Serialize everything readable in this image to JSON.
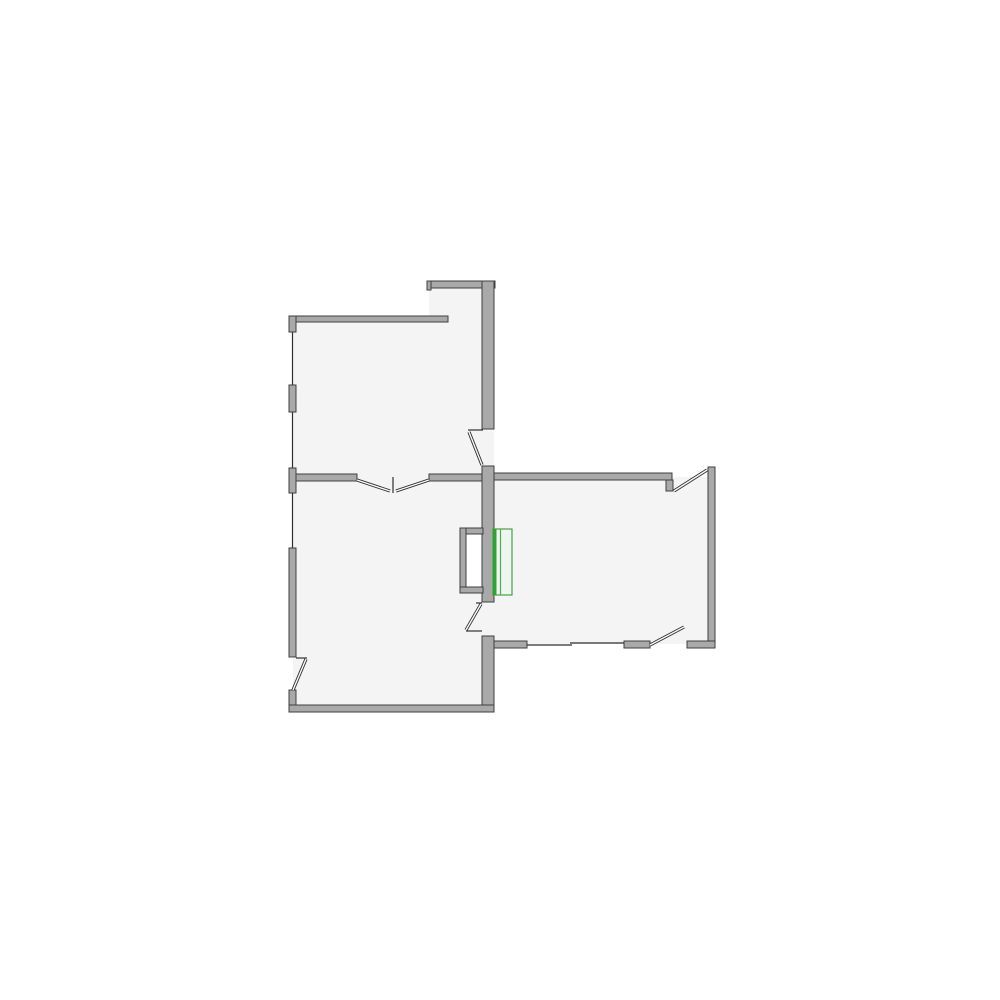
{
  "palette": {
    "background": "#ffffff",
    "room_fill": "#f4f4f5",
    "wall_fill": "#a9a9a9",
    "wall_stroke": "#3f3f3f",
    "window_line": "#2f2f2f",
    "door_line": "#2f2f2f",
    "leaf_core": "#fafafa",
    "void_fill": "#ffffff",
    "radiator_outline": "#46a046",
    "radiator_accent": "#2fa32f",
    "radiator_divider": "#55a855",
    "radiator_fill": "#eff5ef"
  },
  "floorplan": {
    "canvas": {
      "width": 1000,
      "height": 1000
    },
    "rooms": [
      {
        "name": "room-top-left-alcove",
        "x": 429,
        "y": 286,
        "w": 57,
        "h": 36
      },
      {
        "name": "room-top-left",
        "x": 293,
        "y": 320,
        "w": 193,
        "h": 161
      },
      {
        "name": "room-bottom-left",
        "x": 293,
        "y": 474,
        "w": 193,
        "h": 234
      },
      {
        "name": "room-right",
        "x": 486,
        "y": 477,
        "w": 226,
        "h": 167
      }
    ],
    "doorway_fills": [
      {
        "name": "doorway-upper-spine",
        "x": 482,
        "y": 429,
        "w": 12,
        "h": 37
      },
      {
        "name": "doorway-lower-spine",
        "x": 482,
        "y": 602,
        "w": 12,
        "h": 34
      }
    ],
    "void_interior": {
      "name": "wall-niche-interior",
      "x": 466,
      "y": 534,
      "w": 17,
      "h": 53
    },
    "walls": [
      {
        "name": "wall-alcove-top",
        "x": 429,
        "y": 281,
        "w": 66,
        "h": 7
      },
      {
        "name": "wall-alcove-end-cap",
        "x": 427,
        "y": 281,
        "w": 4,
        "h": 9
      },
      {
        "name": "wall-topleft-top",
        "x": 289,
        "y": 316,
        "w": 159,
        "h": 6
      },
      {
        "name": "wall-left-block-1",
        "x": 289,
        "y": 316,
        "w": 7,
        "h": 16
      },
      {
        "name": "wall-left-block-2",
        "x": 289,
        "y": 385,
        "w": 7,
        "h": 27
      },
      {
        "name": "wall-left-block-3",
        "x": 289,
        "y": 468,
        "w": 7,
        "h": 25
      },
      {
        "name": "wall-left-block-4",
        "x": 289,
        "y": 548,
        "w": 7,
        "h": 109
      },
      {
        "name": "wall-left-block-5",
        "x": 289,
        "y": 690,
        "w": 7,
        "h": 22
      },
      {
        "name": "wall-interior-left",
        "x": 296,
        "y": 474,
        "w": 61,
        "h": 7
      },
      {
        "name": "wall-interior-right",
        "x": 429,
        "y": 474,
        "w": 54,
        "h": 7
      },
      {
        "name": "wall-spine-top",
        "x": 482,
        "y": 281,
        "w": 12,
        "h": 148
      },
      {
        "name": "wall-spine-mid",
        "x": 482,
        "y": 466,
        "w": 12,
        "h": 136
      },
      {
        "name": "wall-spine-bottom",
        "x": 482,
        "y": 636,
        "w": 12,
        "h": 76
      },
      {
        "name": "wall-bottomleft-bottom",
        "x": 289,
        "y": 705,
        "w": 205,
        "h": 7
      },
      {
        "name": "wall-right-room-top",
        "x": 494,
        "y": 473,
        "w": 178,
        "h": 7
      },
      {
        "name": "wall-right-top-door-notch",
        "x": 666,
        "y": 480,
        "w": 7,
        "h": 11
      },
      {
        "name": "wall-right-room-right",
        "x": 708,
        "y": 467,
        "w": 7,
        "h": 181
      },
      {
        "name": "wall-right-room-bottom-corner",
        "x": 687,
        "y": 641,
        "w": 28,
        "h": 7
      },
      {
        "name": "wall-right-room-bottom-mid",
        "x": 624,
        "y": 641,
        "w": 26,
        "h": 7
      },
      {
        "name": "wall-right-room-bottom-left",
        "x": 494,
        "y": 641,
        "w": 33,
        "h": 7
      },
      {
        "name": "wall-niche-top",
        "x": 460,
        "y": 528,
        "w": 23,
        "h": 6
      },
      {
        "name": "wall-niche-left",
        "x": 460,
        "y": 528,
        "w": 6,
        "h": 65
      },
      {
        "name": "wall-niche-bottom",
        "x": 460,
        "y": 587,
        "w": 23,
        "h": 6
      }
    ],
    "windows": [
      {
        "name": "window-left-1",
        "x1": 292.5,
        "y1": 332,
        "x2": 292.5,
        "y2": 385
      },
      {
        "name": "window-left-2",
        "x1": 292.5,
        "y1": 412,
        "x2": 292.5,
        "y2": 468
      },
      {
        "name": "window-left-3",
        "x1": 292.5,
        "y1": 493,
        "x2": 292.5,
        "y2": 548
      },
      {
        "name": "window-right-bottom-a",
        "x1": 527,
        "y1": 645,
        "x2": 572,
        "y2": 645
      },
      {
        "name": "window-right-bottom-b",
        "x1": 570,
        "y1": 643,
        "x2": 624,
        "y2": 643
      }
    ],
    "door_ticks": [
      {
        "name": "door-upper-spine-jamb",
        "x1": 468,
        "y1": 430,
        "x2": 483,
        "y2": 430
      },
      {
        "name": "door-double-center-post",
        "x1": 393,
        "y1": 477,
        "x2": 393,
        "y2": 493
      },
      {
        "name": "door-lower-spine-jamb-top",
        "x1": 476,
        "y1": 603,
        "x2": 482,
        "y2": 603
      },
      {
        "name": "door-lower-spine-jamb-bottom",
        "x1": 466,
        "y1": 631,
        "x2": 482,
        "y2": 631
      },
      {
        "name": "door-left-exit-jamb",
        "x1": 296,
        "y1": 658,
        "x2": 307,
        "y2": 658
      }
    ],
    "door_leaves": [
      {
        "name": "door-upper-spine-leaf",
        "x1": 469,
        "y1": 432,
        "x2": 482,
        "y2": 465
      },
      {
        "name": "door-double-leaf-left",
        "x1": 357,
        "y1": 480,
        "x2": 390,
        "y2": 491
      },
      {
        "name": "door-double-leaf-right",
        "x1": 429,
        "y1": 480,
        "x2": 396,
        "y2": 491
      },
      {
        "name": "door-lower-spine-leaf",
        "x1": 481,
        "y1": 604,
        "x2": 466,
        "y2": 630
      },
      {
        "name": "door-left-exit-leaf",
        "x1": 306,
        "y1": 659,
        "x2": 293,
        "y2": 690
      },
      {
        "name": "door-right-top-leaf",
        "x1": 674,
        "y1": 491,
        "x2": 707,
        "y2": 470
      },
      {
        "name": "door-right-bottom-leaf",
        "x1": 650,
        "y1": 645,
        "x2": 684,
        "y2": 627
      }
    ],
    "radiator": {
      "name": "radiator",
      "x": 493,
      "y": 529,
      "w": 19,
      "h": 66,
      "accent_w": 3.5,
      "divider_x": 500.5
    }
  }
}
